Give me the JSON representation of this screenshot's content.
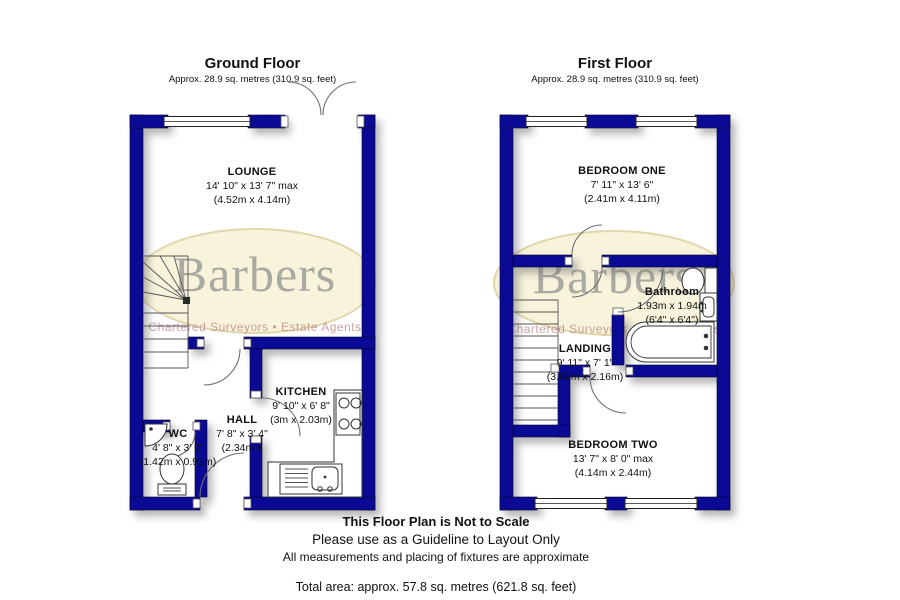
{
  "watermark": {
    "brand": "Barbers",
    "tagline": "Chartered Surveyors • Estate Agents"
  },
  "ground_floor": {
    "title": "Ground Floor",
    "subtitle": "Approx. 28.9 sq. metres (310.9 sq. feet)",
    "rooms": [
      {
        "name": "LOUNGE",
        "dims1": "14' 10\" x 13' 7\" max",
        "dims2": "(4.52m x 4.14m)"
      },
      {
        "name": "KITCHEN",
        "dims1": "9' 10\" x 6' 8\"",
        "dims2": "(3m x 2.03m)"
      },
      {
        "name": "HALL",
        "dims1": "7' 8\" x 3' 4\"",
        "dims2": "(2.34m x"
      },
      {
        "name": "WC",
        "dims1": "4' 8\" x 3' 0\"",
        "dims2": "(1.42m x 0.91m)"
      }
    ]
  },
  "first_floor": {
    "title": "First Floor",
    "subtitle": "Approx. 28.9 sq. metres (310.9 sq. feet)",
    "rooms": [
      {
        "name": "BEDROOM ONE",
        "dims1": "7' 11\" x 13' 6\"",
        "dims2": "(2.41m x 4.11m)"
      },
      {
        "name": "Bathroom",
        "dims1": "1.93m x 1.94m",
        "dims2": "(6'4\" x 6'4\")"
      },
      {
        "name": "LANDING",
        "dims1": "9' 11\" x 7' 1\"",
        "dims2": "(3.02m x 2.16m)"
      },
      {
        "name": "BEDROOM TWO",
        "dims1": "13' 7\" x 8' 0\" max",
        "dims2": "(4.14m x 2.44m)"
      }
    ]
  },
  "footer": {
    "line1": "This Floor Plan is Not to Scale",
    "line2": "Please use as a Guideline to Layout Only",
    "line3": "All measurements and placing of fixtures are approximate",
    "total": "Total area: approx. 57.8 sq. metres (621.8 sq. feet)"
  },
  "colors": {
    "wall": "#0a0a94",
    "watermark_fill": "#f7f1d6",
    "watermark_text": "#7a7a80",
    "tagline_text": "#b07070"
  }
}
